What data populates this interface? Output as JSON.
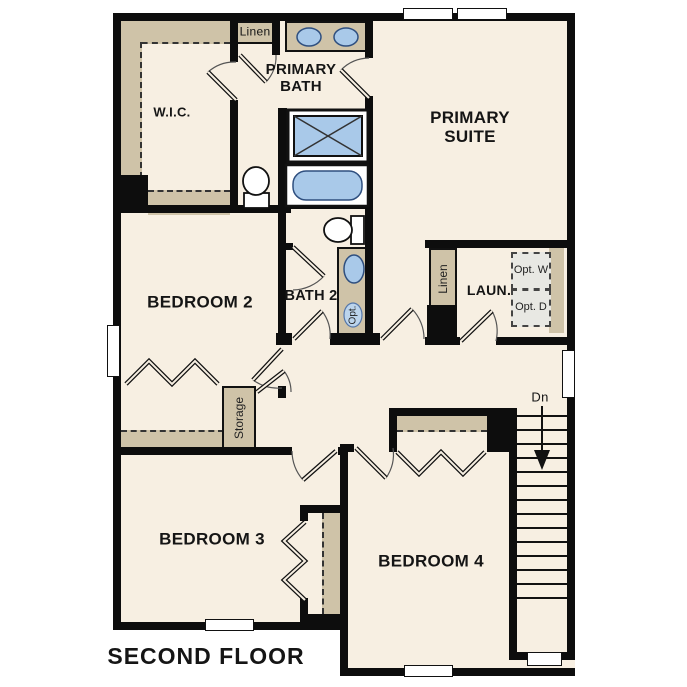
{
  "floor_plan": {
    "title": "SECOND FLOOR",
    "rooms": {
      "wic": "W.I.C.",
      "primary_bath": "PRIMARY BATH",
      "primary_suite": "PRIMARY SUITE",
      "bedroom2": "BEDROOM 2",
      "bath2": "BATH 2",
      "laundry": "LAUN.",
      "bedroom3": "BEDROOM 3",
      "bedroom4": "BEDROOM 4"
    },
    "closets": {
      "linen_hall": "Linen",
      "linen_laundry": "Linen",
      "storage": "Storage"
    },
    "annotations": {
      "stairs_down": "Dn",
      "opt_washer": "Opt. W",
      "opt_dryer": "Opt. D",
      "opt_sink": "Opt."
    },
    "colors": {
      "floor": "#f7efe2",
      "wall": "#0d0d0d",
      "casework_tan": "#cfc3a8",
      "fixture_blue": "#a9c9e9",
      "optional_gray": "#e8e8e3"
    }
  }
}
